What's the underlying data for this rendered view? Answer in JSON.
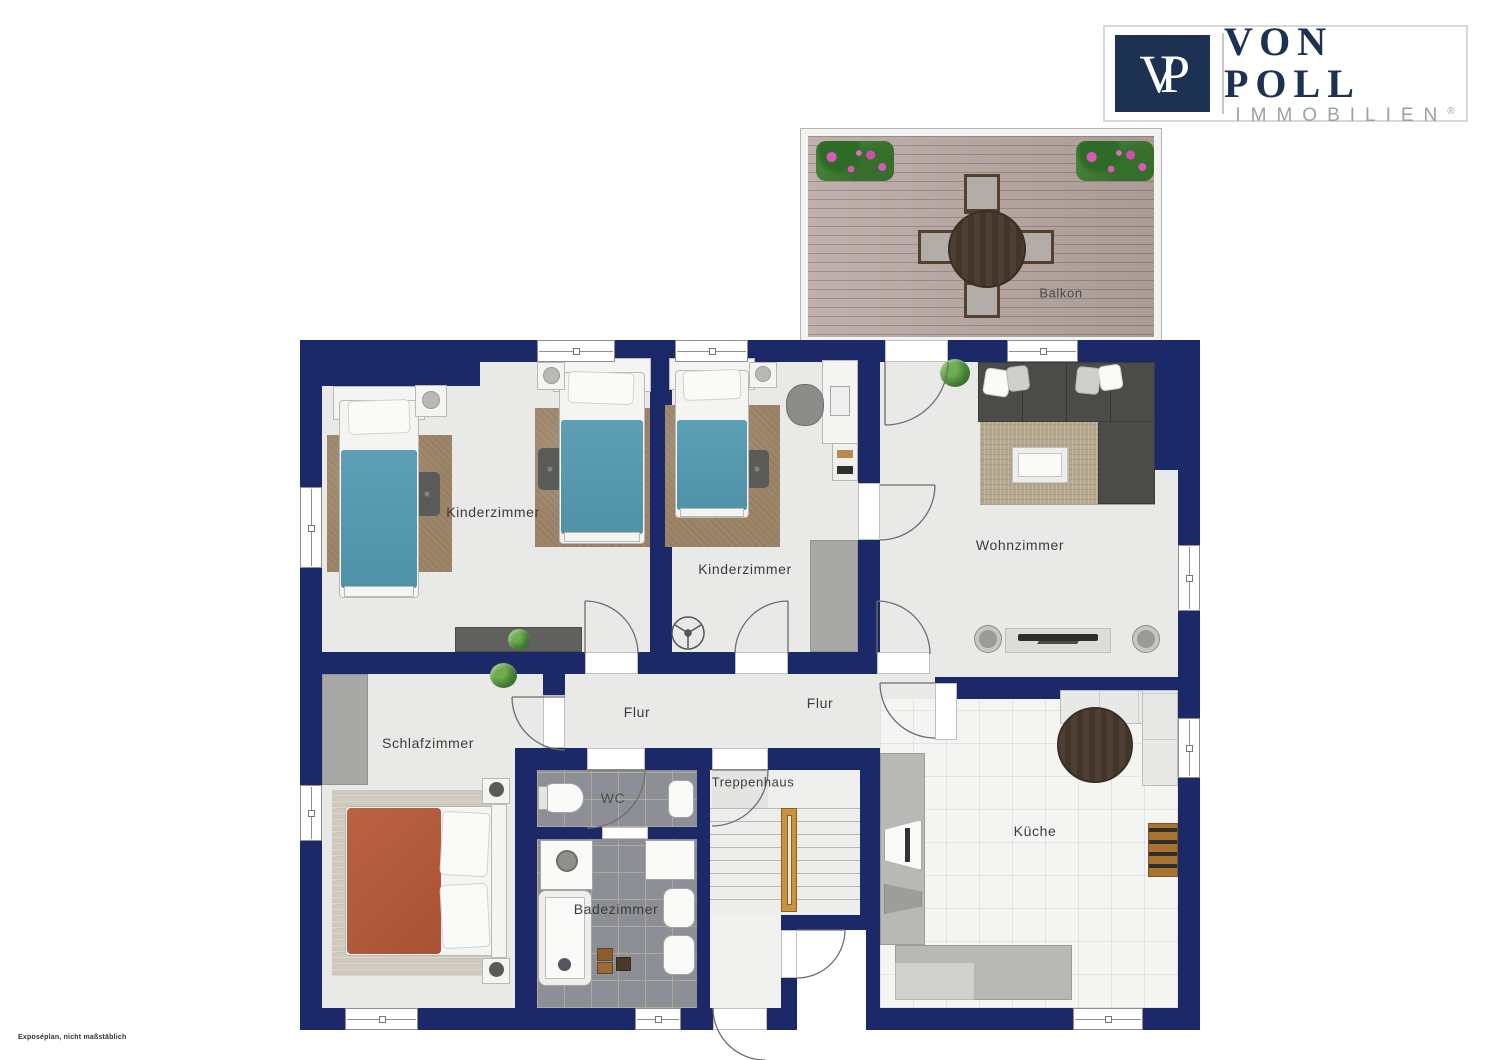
{
  "branding": {
    "logo_initials": "VP",
    "brand_name": "VON POLL",
    "brand_division": "IMMOBILIEN",
    "registered_mark": "®",
    "brand_navy": "#1d3252",
    "brand_gray": "#9ba1a7"
  },
  "plan": {
    "disclaimer": "Exposéplan, nicht maßstäblich",
    "colors": {
      "wall_navy": "#1c2969",
      "floor_gray": "#e9e9e7",
      "bed_teal": "#5597ac",
      "bed_orange": "#b65c3e",
      "stair_rail_wood": "#c8923f",
      "deck_wood": "#b5a5a0",
      "bath_tile": "#8c8f95"
    },
    "rooms": {
      "balkon": {
        "label": "Balkon"
      },
      "kinderzimmer_1": {
        "label": "Kinderzimmer"
      },
      "kinderzimmer_2": {
        "label": "Kinderzimmer"
      },
      "wohnzimmer": {
        "label": "Wohnzimmer"
      },
      "flur_1": {
        "label": "Flur"
      },
      "flur_2": {
        "label": "Flur"
      },
      "schlafzimmer": {
        "label": "Schlafzimmer"
      },
      "wc": {
        "label": "WC"
      },
      "badezimmer": {
        "label": "Badezimmer"
      },
      "treppenhaus": {
        "label": "Treppenhaus"
      },
      "kueche": {
        "label": "Küche"
      }
    }
  }
}
